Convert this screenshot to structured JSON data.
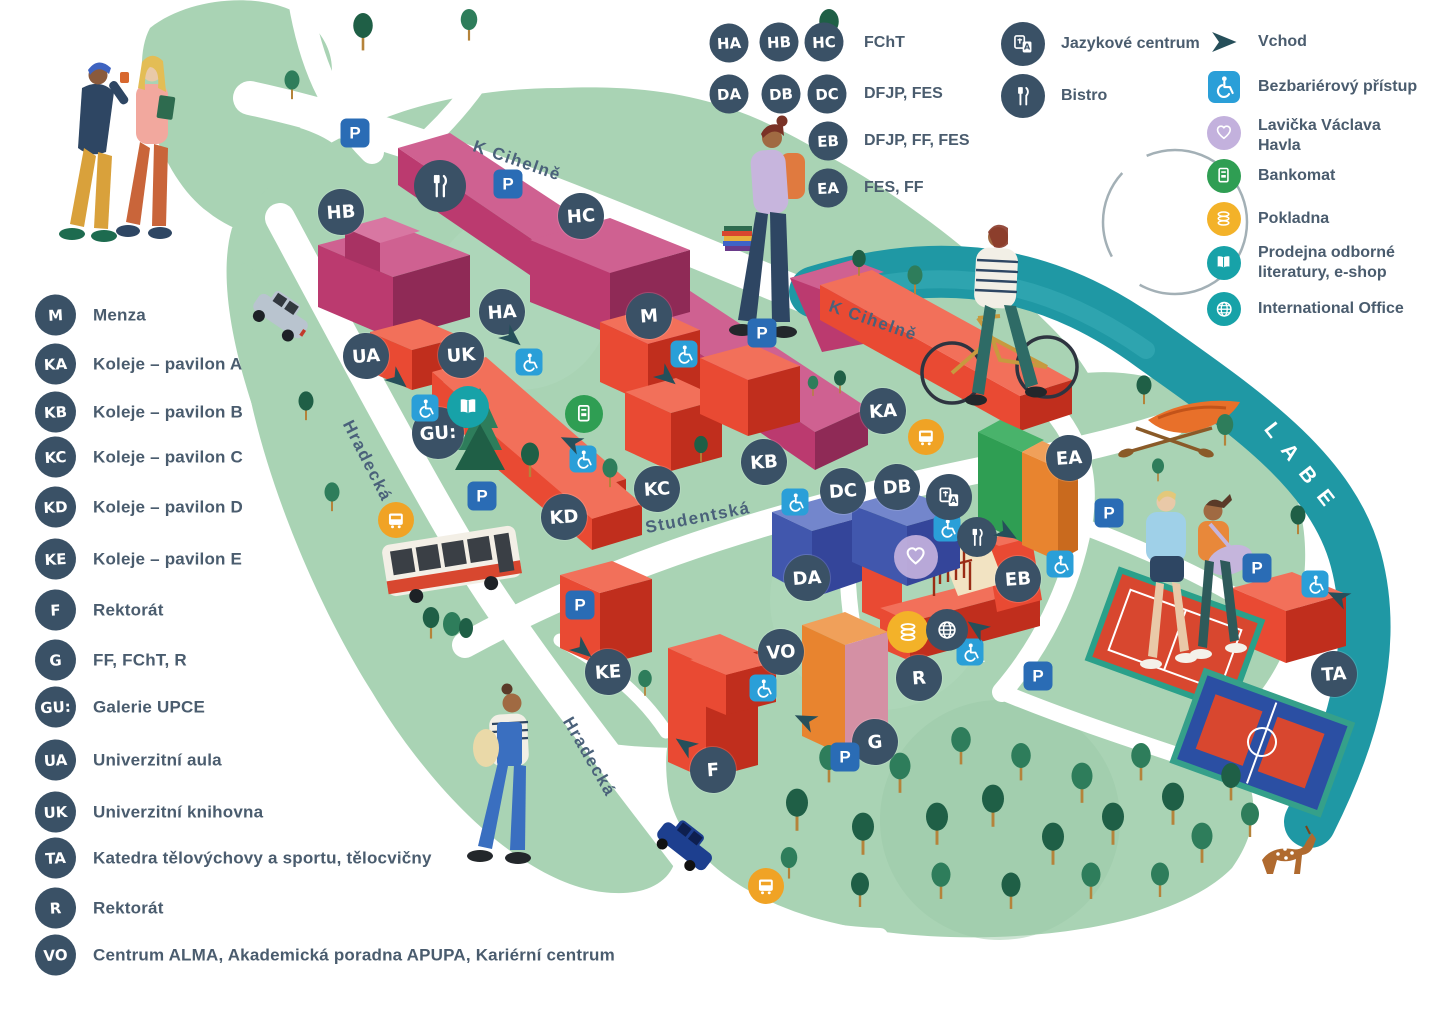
{
  "legend": {
    "buildings": [
      {
        "code": "M",
        "label": "Menza"
      },
      {
        "code": "KA",
        "label": "Koleje – pavilon A"
      },
      {
        "code": "KB",
        "label": "Koleje – pavilon B"
      },
      {
        "code": "KC",
        "label": "Koleje – pavilon C"
      },
      {
        "code": "KD",
        "label": "Koleje – pavilon D"
      },
      {
        "code": "KE",
        "label": "Koleje – pavilon E"
      },
      {
        "code": "F",
        "label": "Rektorát"
      },
      {
        "code": "G",
        "label": "FF, FChT, R"
      },
      {
        "code": "GU:",
        "label": "Galerie UPCE"
      },
      {
        "code": "UA",
        "label": "Univerzitní aula"
      },
      {
        "code": "UK",
        "label": "Univerzitní knihovna"
      },
      {
        "code": "TA",
        "label": "Katedra tělovýchovy a sportu, tělocvičny"
      },
      {
        "code": "R",
        "label": "Rektorát"
      },
      {
        "code": "VO",
        "label": "Centrum ALMA, Akademická poradna APUPA, Kariérní centrum"
      }
    ],
    "faculties": [
      {
        "codes": [
          "HA",
          "HB",
          "HC"
        ],
        "label": "FChT"
      },
      {
        "codes": [
          "DA",
          "DB",
          "DC"
        ],
        "label": "DFJP, FES"
      },
      {
        "codes": [
          "EB"
        ],
        "label": "DFJP, FF, FES"
      },
      {
        "codes": [
          "EA"
        ],
        "label": "FES, FF"
      }
    ],
    "services": [
      {
        "icon": "language-centre-icon",
        "label": "Jazykové centrum"
      },
      {
        "icon": "bistro-icon",
        "label": "Bistro"
      }
    ],
    "symbols": [
      {
        "icon": "entrance-arrow-icon",
        "label": "Vchod"
      },
      {
        "icon": "wheelchair-icon",
        "label": "Bezbariérový přístup"
      },
      {
        "icon": "heart-bench-icon",
        "label": "Lavička Václava Havla"
      },
      {
        "icon": "atm-icon",
        "label": "Bankomat"
      },
      {
        "icon": "cash-icon",
        "label": "Pokladna"
      },
      {
        "icon": "bookshop-icon",
        "label": "Prodejna odborné literatury, e-shop"
      },
      {
        "icon": "globe-icon",
        "label": "International Office"
      }
    ]
  },
  "streets": {
    "k_cihelne": "K Cihelně",
    "hradecka": "Hradecká",
    "studentska": "Studentská",
    "river": "LABE"
  },
  "signs": {
    "parking": "P"
  },
  "map_markers": [
    "HB",
    "HC",
    "HA",
    "M",
    "UA",
    "UK",
    "GU:",
    "KD",
    "KC",
    "KB",
    "KA",
    "DC",
    "DB",
    "DA",
    "EA",
    "EB",
    "KE",
    "F",
    "VO",
    "G",
    "R",
    "TA"
  ],
  "colors": {
    "marker_navy": "#3a5166",
    "parking_blue": "#2a6cb5",
    "access_blue": "#2a9fd8",
    "bus_orange": "#f0a325",
    "atm_green": "#2f9e53",
    "cash_yellow": "#f3b229",
    "shop_teal": "#17a2a8",
    "heart_lavender": "#c3b1dd",
    "building_red": "#e94a33",
    "building_magenta": "#bb3a6f",
    "building_blue": "#4157ad",
    "building_green": "#2f9e53",
    "building_orange": "#e8842f",
    "park_green": "#a9d3b4",
    "tree_green": "#1f5f46",
    "river_teal": "#1f98a4",
    "text_slate": "#4a5c6e"
  }
}
